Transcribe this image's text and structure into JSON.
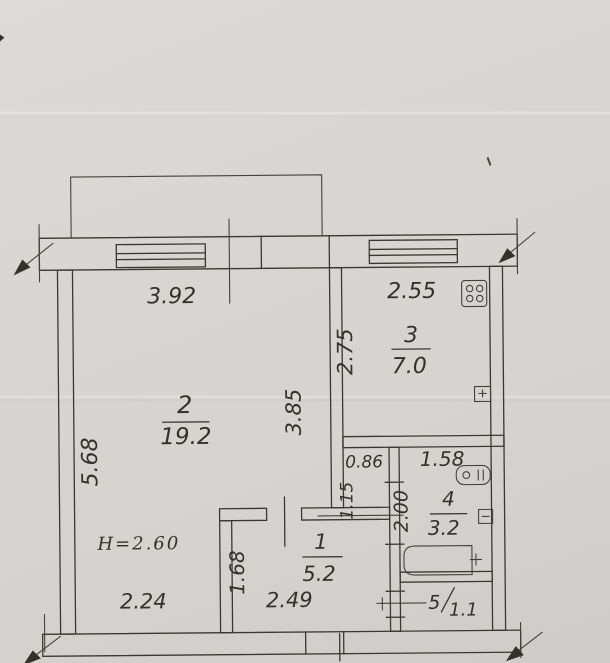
{
  "plan": {
    "height_note": "H=2.60",
    "rooms": {
      "living": {
        "number": "2",
        "area": "19.2"
      },
      "kitchen": {
        "number": "3",
        "area": "7.0"
      },
      "bath": {
        "number": "4",
        "area": "3.2"
      },
      "hall": {
        "number": "1",
        "area": "5.2"
      },
      "wc": {
        "number": "5",
        "area": "1.1"
      }
    },
    "dims": {
      "top_window_width": "3.92",
      "kitchen_width": "2.55",
      "left_height": "5.68",
      "living_inner_height": "3.85",
      "kitchen_depth": "2.75",
      "niche_width": "0.86",
      "niche_height": "1.15",
      "bath_width": "1.58",
      "bath_depth": "2.00",
      "bottom_left_width": "2.24",
      "hall_depth": "1.68",
      "hall_width": "2.49"
    },
    "colors": {
      "paper": "#d8d6d3",
      "ink": "#3b3833"
    }
  }
}
